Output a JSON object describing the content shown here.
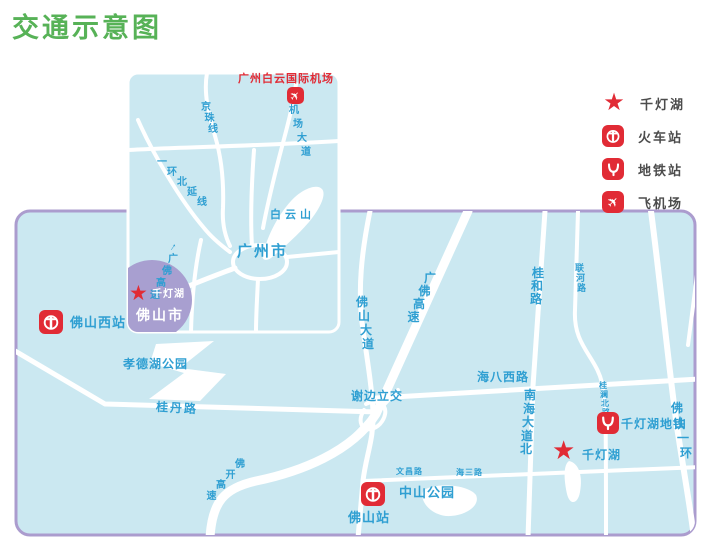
{
  "title": "交通示意图",
  "legend": {
    "items": [
      {
        "icon": "qiandenghu-star",
        "label": "千灯湖"
      },
      {
        "icon": "railway-station",
        "label": "火车站"
      },
      {
        "icon": "metro-station",
        "label": "地铁站"
      },
      {
        "icon": "airport",
        "label": "飞机场"
      }
    ]
  },
  "icons": {
    "star": "★",
    "plane": "✈",
    "arrow": "↑"
  },
  "inset": {
    "airport": "广州白云国际机场",
    "baiyun_mountain": "白云山",
    "guangzhou_city": "广州市",
    "foshan_city": "佛山市",
    "qiandeng_lake": "千灯湖",
    "roads": {
      "jingzhu_line": "京珠线",
      "jichang_dadao": "机场大道",
      "yihuan_beiyan": "一环北延线",
      "guangfo_gaosu": "广佛高速"
    }
  },
  "main": {
    "stations": {
      "foshan_west": "佛山西站",
      "foshan": "佛山站",
      "qiandeng_metro": "千灯湖地铁"
    },
    "places": {
      "xiaodehu_park": "孝德湖公园",
      "zhongshan_park": "中山公园",
      "qiandeng_lake": "千灯湖"
    },
    "roads": {
      "guidan": "桂丹路",
      "fokai_gaosu": "佛开高速",
      "foshan_dadao": "佛山大道",
      "guangfo_gaosu": "广佛高速",
      "xiebian_interchange": "谢边立交",
      "haiba_west": "海八西路",
      "guihe": "桂和路",
      "lianhe": "联河路",
      "nanhai_dadao_north": "南海大道北",
      "guilan_north": "桂澜北路",
      "foshan_yihuan": "佛山一环",
      "wenchang": "文昌路",
      "haisan": "海三路"
    }
  },
  "colors": {
    "title_green": "#57b257",
    "map_fill": "#cbe8f1",
    "map_border_purple": "#ab9cce",
    "road_label_blue": "#2f9fd2",
    "marker_red": "#e12b35",
    "foshan_circle_purple": "#a89fd0",
    "road_white": "#ffffff"
  }
}
